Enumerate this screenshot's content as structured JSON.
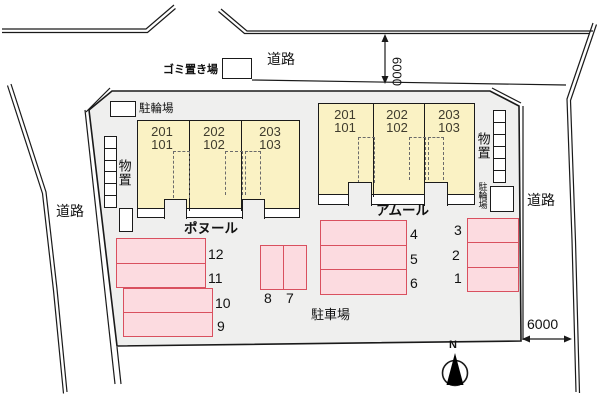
{
  "colors": {
    "site_fill": "#efefee",
    "building_fill": "#faf2c4",
    "parking_fill": "#fcdbe0",
    "parking_border": "#d9505f"
  },
  "roads": {
    "top_label": "道路",
    "left_label": "道路",
    "right_label": "道路"
  },
  "dimensions": {
    "top_road_width": "6000",
    "right_road_width": "6000"
  },
  "compass": {
    "north": "N"
  },
  "facilities": {
    "garbage": "ゴミ置き場",
    "bike_parking_top": "駐輪場",
    "storage_left": "物置",
    "storage_right": "物置",
    "bike_parking_right": "駐輪場",
    "parking_lot": "駐車場"
  },
  "buildings": [
    {
      "name": "ポヌール",
      "units": [
        {
          "upper": "201",
          "lower": "101"
        },
        {
          "upper": "202",
          "lower": "102"
        },
        {
          "upper": "203",
          "lower": "103"
        }
      ]
    },
    {
      "name": "アムール",
      "units": [
        {
          "upper": "201",
          "lower": "101"
        },
        {
          "upper": "202",
          "lower": "102"
        },
        {
          "upper": "203",
          "lower": "103"
        }
      ]
    }
  ],
  "parking": {
    "blocks": {
      "a": [
        "12",
        "11"
      ],
      "b": [
        "10",
        "9"
      ],
      "c": [
        "8",
        "7"
      ],
      "d": [
        "4",
        "5",
        "6"
      ],
      "e": [
        "3",
        "2",
        "1"
      ]
    }
  }
}
